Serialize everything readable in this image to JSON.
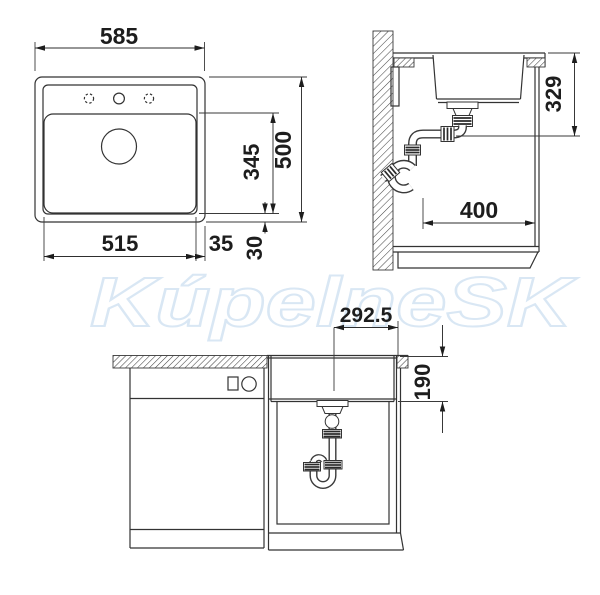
{
  "watermark": "KúpelneSK",
  "colors": {
    "line": "#333333",
    "dim_text": "#1d1d1d",
    "watermark": "#d9e7f4",
    "background": "#ffffff"
  },
  "views": {
    "top": {
      "overall_width": "585",
      "basin_width": "515",
      "basin_side_offset": "35",
      "basin_front_offset": "30",
      "basin_length": "345",
      "overall_depth": "500"
    },
    "side": {
      "drain_height": "329",
      "clearance_depth": "400"
    },
    "front": {
      "drain_center_offset": "292.5",
      "bowl_depth": "190"
    }
  }
}
